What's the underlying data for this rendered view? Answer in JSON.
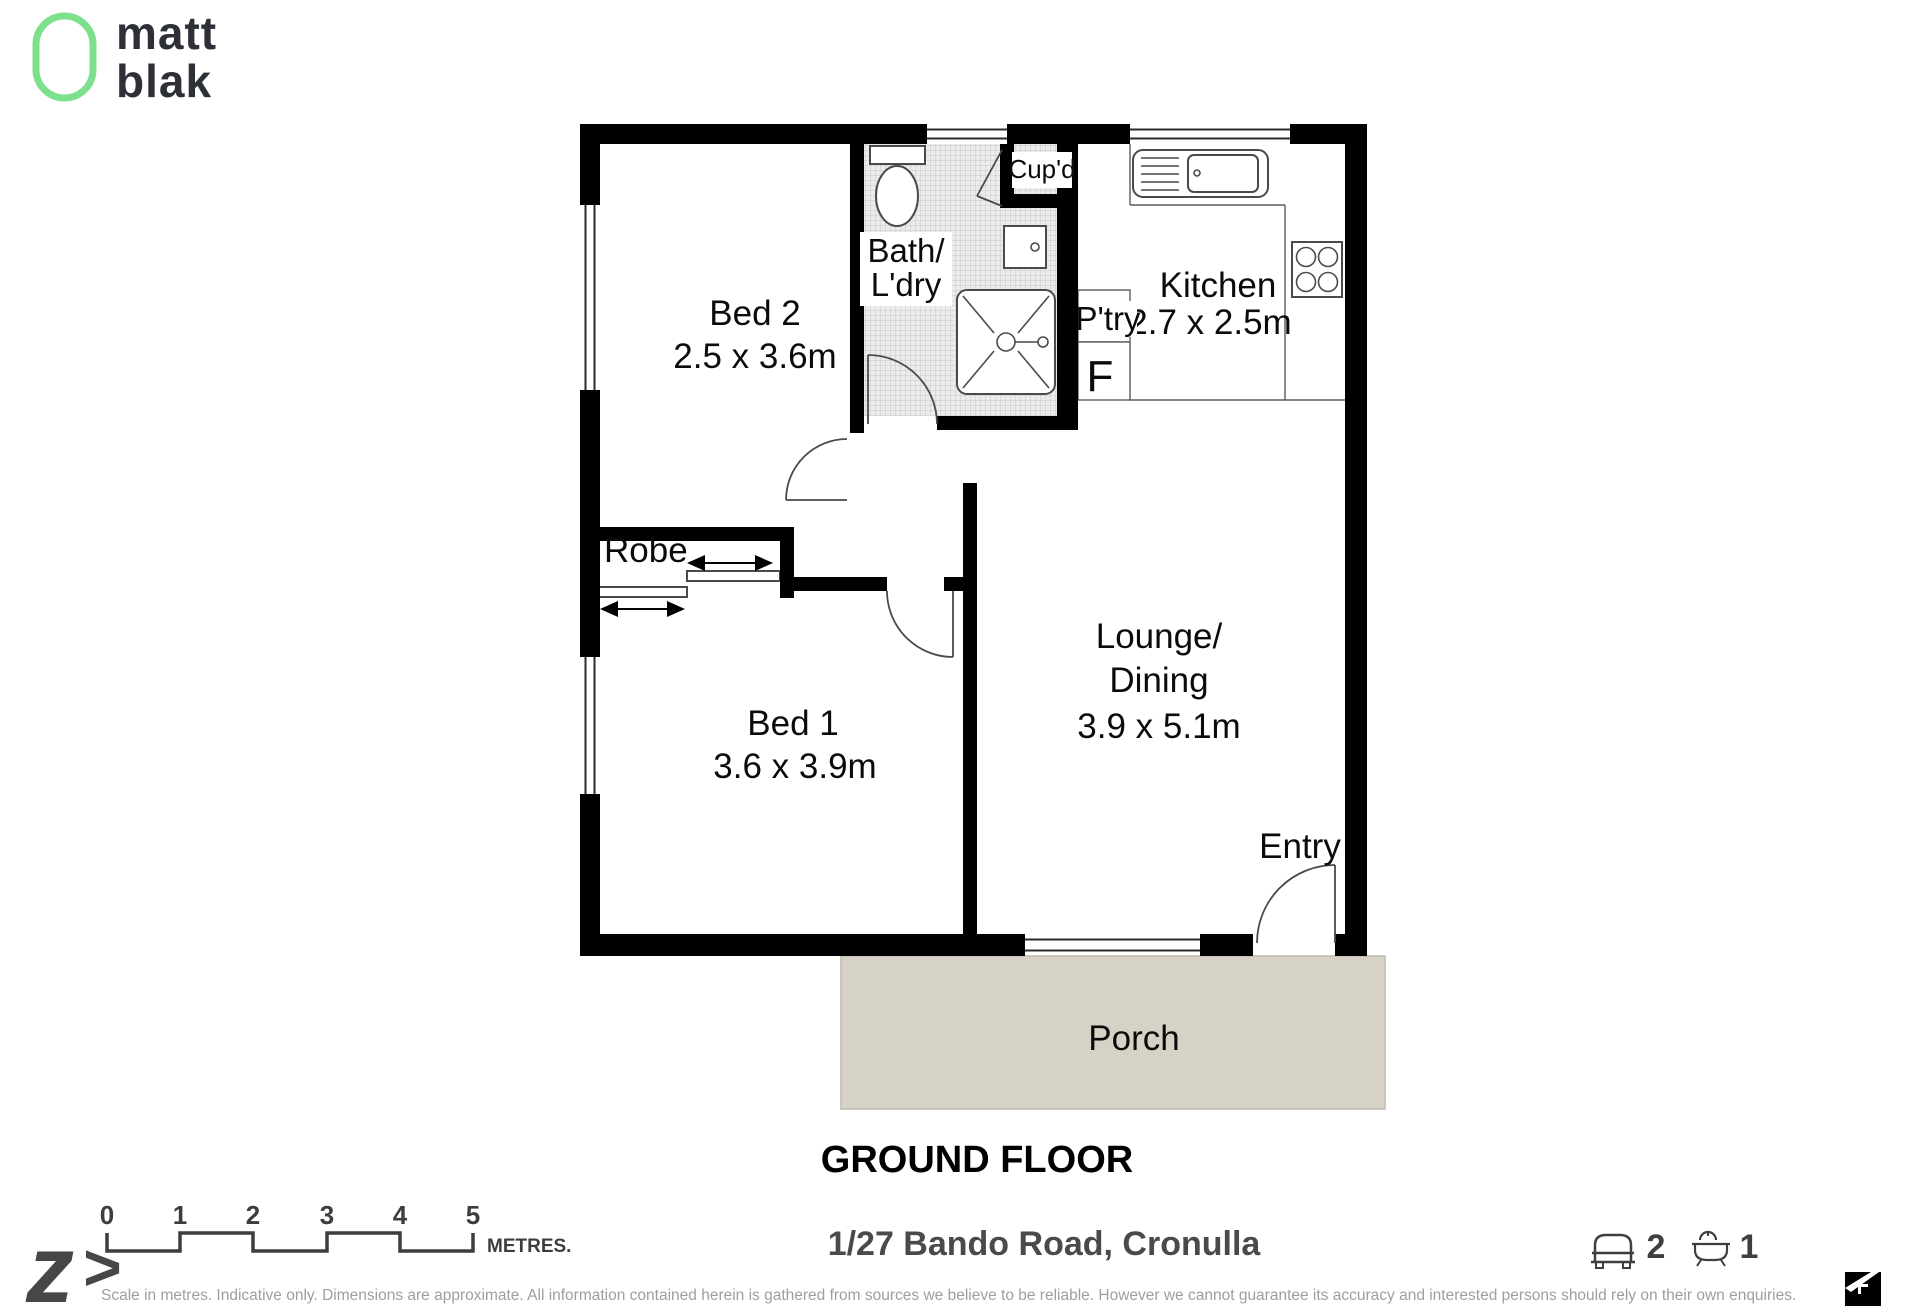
{
  "branding": {
    "logo_word1": "matt",
    "logo_word2": "blak"
  },
  "plan": {
    "floor_title": "GROUND FLOOR",
    "rooms": {
      "bed2_name": "Bed 2",
      "bed2_dims": "2.5 x 3.6m",
      "bed1_name": "Bed 1",
      "bed1_dims": "3.6 x 3.9m",
      "kitchen_name": "Kitchen",
      "kitchen_dims": "2.7 x 2.5m",
      "lounge_line1": "Lounge/",
      "lounge_line2": "Dining",
      "lounge_dims": "3.9 x 5.1m",
      "bath_line1": "Bath/",
      "bath_line2": "L'dry",
      "cupboard": "Cup'd",
      "pantry": "P'try",
      "fridge": "F",
      "robe": "Robe",
      "entry": "Entry",
      "porch": "Porch"
    }
  },
  "footer": {
    "zed_glyph": "z",
    "zed_arrow": ">",
    "scale_ticks": [
      "0",
      "1",
      "2",
      "3",
      "4",
      "5"
    ],
    "scale_unit": "METRES.",
    "address": "1/27 Bando Road, Cronulla",
    "bed_count": "2",
    "bath_count": "1",
    "disclaimer": "Scale in metres. Indicative only. Dimensions are approximate. All information contained herein is gathered from sources we believe to be reliable. However we cannot guarantee its accuracy and interested persons should rely on their own enquiries."
  },
  "colors": {
    "accent_green": "#7de08d",
    "porch_fill": "#d6d3c6",
    "wall_black": "#000000",
    "text_dark": "#2d3037",
    "muted_grey": "#9e9e9e",
    "icon_grey": "#3f3f3f"
  }
}
